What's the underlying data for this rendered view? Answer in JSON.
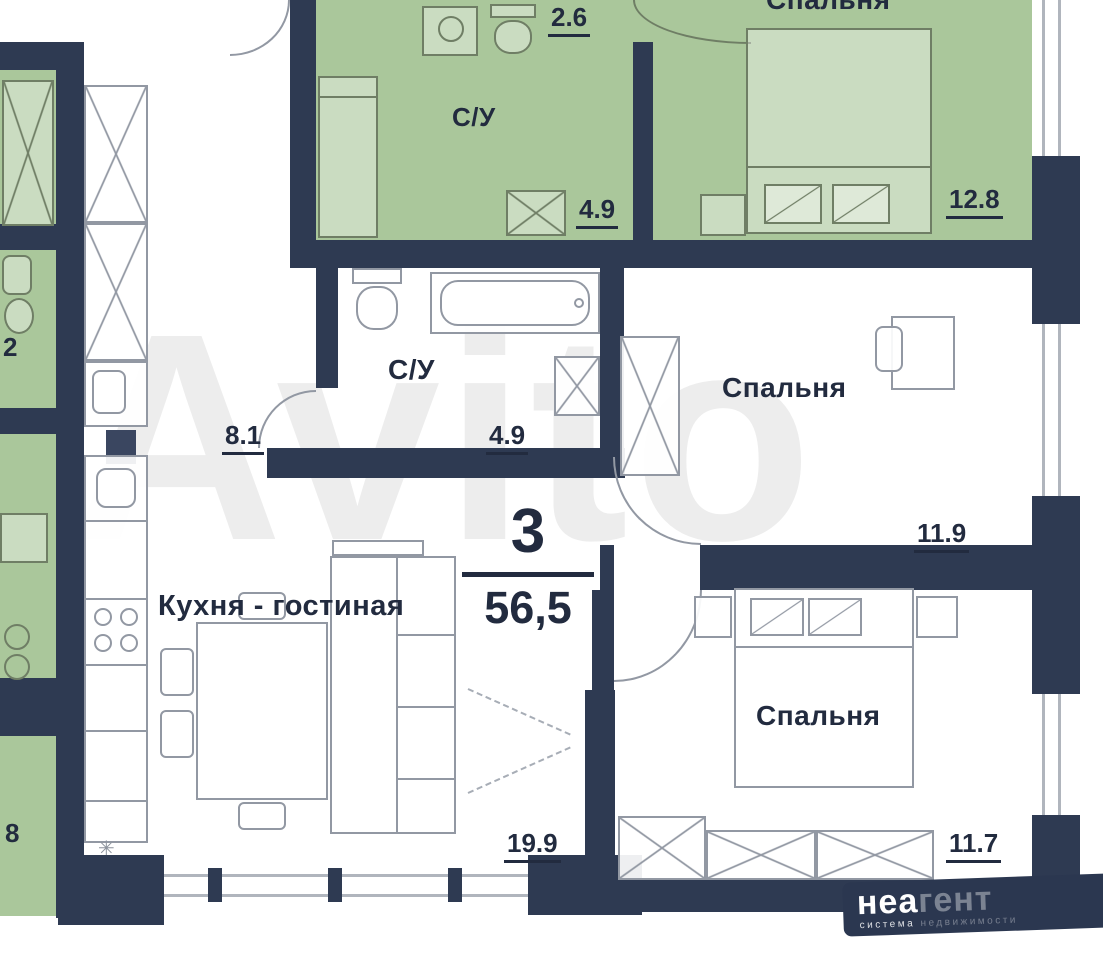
{
  "center": {
    "rooms_count": "3",
    "total_area": "56,5"
  },
  "rooms": {
    "hallway": {
      "area": "8.1"
    },
    "bathroom": {
      "name": "С/У",
      "area": "4.9"
    },
    "kitchen_living": {
      "name": "Кухня - гостиная",
      "area": "19.9"
    },
    "bedroom_middle": {
      "name": "Спальня",
      "area": "11.9"
    },
    "bedroom_bottom": {
      "name": "Спальня",
      "area": "11.7"
    }
  },
  "neighbors": {
    "top_bathroom": {
      "name": "С/У",
      "area": "4.9"
    },
    "top_vestibule": {
      "area": "2.6"
    },
    "top_bedroom": {
      "name": "Спальня",
      "area": "12.8"
    },
    "left_room_upper": {
      "area": "2"
    },
    "left_room_lower": {
      "area": "8"
    }
  },
  "watermark": {
    "text": "Avito"
  },
  "logo": {
    "brand_strong": "неа",
    "brand_light": "гент",
    "subtitle_strong": "система",
    "subtitle_light": "недвижимости"
  },
  "colors": {
    "wall": "#2e3a52",
    "green": "#aac79b",
    "label": "#222b3f"
  }
}
